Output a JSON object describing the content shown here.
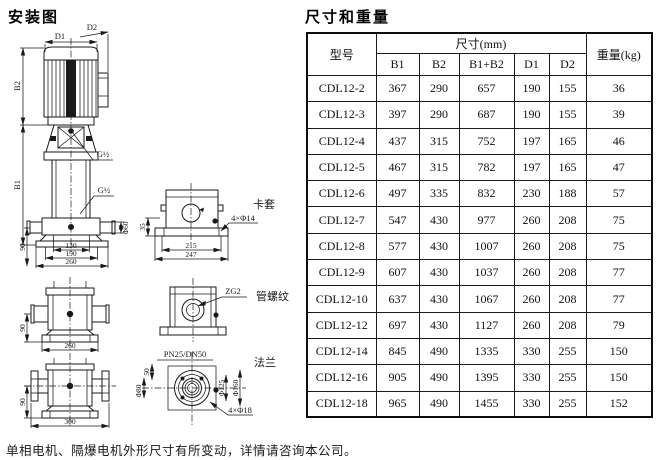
{
  "page": {
    "left_title": "安装图",
    "right_title": "尺寸和重量",
    "footnote": "单相电机、隔爆电机外形尺寸有所变动，详情请咨询本公司。"
  },
  "table": {
    "col_model": "型号",
    "col_dims_group": "尺寸(mm)",
    "col_weight": "重量(kg)",
    "dim_cols": [
      "B1",
      "B2",
      "B1+B2",
      "D1",
      "D2"
    ],
    "row_keys": [
      "model",
      "b1",
      "b2",
      "b1b2",
      "d1",
      "d2",
      "w"
    ],
    "rows": [
      {
        "model": "CDL12-2",
        "b1": 367,
        "b2": 290,
        "b1b2": 657,
        "d1": 190,
        "d2": 155,
        "w": 36
      },
      {
        "model": "CDL12-3",
        "b1": 397,
        "b2": 290,
        "b1b2": 687,
        "d1": 190,
        "d2": 155,
        "w": 39
      },
      {
        "model": "CDL12-4",
        "b1": 437,
        "b2": 315,
        "b1b2": 752,
        "d1": 197,
        "d2": 165,
        "w": 46
      },
      {
        "model": "CDL12-5",
        "b1": 467,
        "b2": 315,
        "b1b2": 782,
        "d1": 197,
        "d2": 165,
        "w": 47
      },
      {
        "model": "CDL12-6",
        "b1": 497,
        "b2": 335,
        "b1b2": 832,
        "d1": 230,
        "d2": 188,
        "w": 57
      },
      {
        "model": "CDL12-7",
        "b1": 547,
        "b2": 430,
        "b1b2": 977,
        "d1": 260,
        "d2": 208,
        "w": 75
      },
      {
        "model": "CDL12-8",
        "b1": 577,
        "b2": 430,
        "b1b2": 1007,
        "d1": 260,
        "d2": 208,
        "w": 75
      },
      {
        "model": "CDL12-9",
        "b1": 607,
        "b2": 430,
        "b1b2": 1037,
        "d1": 260,
        "d2": 208,
        "w": 77
      },
      {
        "model": "CDL12-10",
        "b1": 637,
        "b2": 430,
        "b1b2": 1067,
        "d1": 260,
        "d2": 208,
        "w": 77
      },
      {
        "model": "CDL12-12",
        "b1": 697,
        "b2": 430,
        "b1b2": 1127,
        "d1": 260,
        "d2": 208,
        "w": 79
      },
      {
        "model": "CDL12-14",
        "b1": 845,
        "b2": 490,
        "b1b2": 1335,
        "d1": 330,
        "d2": 255,
        "w": 150
      },
      {
        "model": "CDL12-16",
        "b1": 905,
        "b2": 490,
        "b1b2": 1395,
        "d1": 330,
        "d2": 255,
        "w": 150
      },
      {
        "model": "CDL12-18",
        "b1": 965,
        "b2": 490,
        "b1b2": 1455,
        "d1": 330,
        "d2": 255,
        "w": 152
      }
    ]
  },
  "diagram": {
    "labels": {
      "d1": "D1",
      "d2": "D2",
      "b1": "B1",
      "b2": "B2",
      "g_port_upper": "G½",
      "g_port_lower": "G½",
      "dim_130": "130",
      "dim_190": "190",
      "dim_260": "260",
      "dim_90_main": "90",
      "dia_60": "Φ60",
      "dim_35": "35",
      "dim_215": "215",
      "dim_247": "247",
      "holes_4x14": "4×Φ14",
      "clamp": "卡套",
      "dim_90_front": "90",
      "dim_260_front": "260",
      "zg2": "ZG2",
      "pipe_thread": "管螺纹",
      "dim_90_flanged": "90",
      "dim_300": "300",
      "pn_dn": "PN25/DN50",
      "dim_50": "50",
      "dia_80": "Φ80",
      "dia_125": "Φ125",
      "dia_160": "Φ160",
      "holes_4x18": "4×Φ18",
      "flange": "法兰"
    },
    "line_color": "#1a1a1a"
  }
}
